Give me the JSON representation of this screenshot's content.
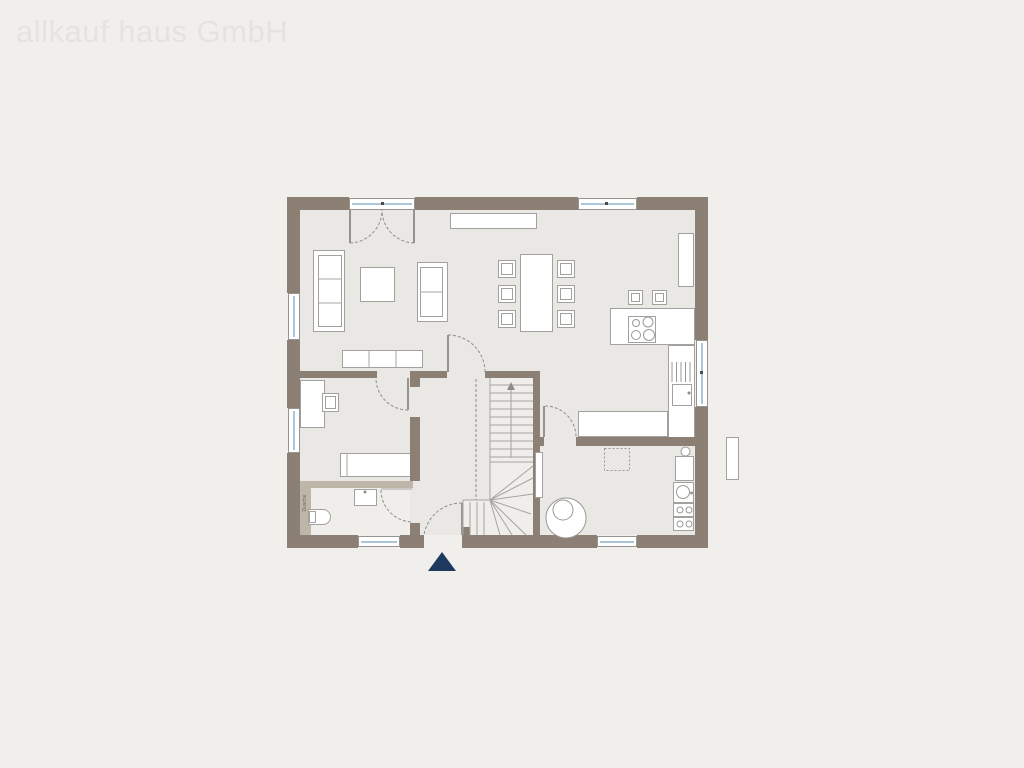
{
  "watermark": {
    "text": "allkauf haus GmbH"
  },
  "plan": {
    "room_labels": {
      "shower": "Dusche"
    },
    "icons": {
      "entrance_marker": "navy-triangle",
      "stair_direction": "up-arrow"
    }
  },
  "colors": {
    "bg": "#f0efec",
    "floor": "#e9e8e4",
    "wall": "#8c8074",
    "wall_light": "#bfb6aa",
    "glass_line": "#abc6d8",
    "line": "#a3a19d",
    "navy": "#1d3a5e",
    "watermark": "#e4e3e0"
  }
}
